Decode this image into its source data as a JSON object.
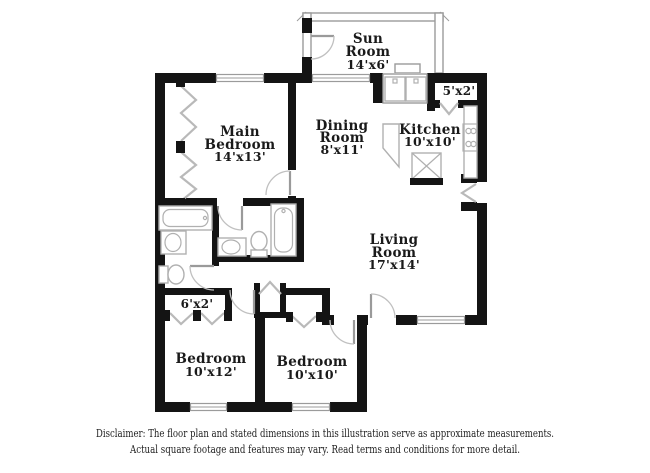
{
  "page": {
    "background": "#ffffff"
  },
  "colors": {
    "wall": "#141414",
    "fixture_outline": "#b0b0b0",
    "door_swing": "#c0c0c0",
    "label_text": "#1a1a1a"
  },
  "rooms": {
    "sun_room": {
      "line1": "Sun",
      "line2": "Room",
      "dims": "14'x6'"
    },
    "main_bedroom": {
      "line1": "Main",
      "line2": "Bedroom",
      "dims": "14'x13'"
    },
    "dining_room": {
      "line1": "Dining",
      "line2": "Room",
      "dims": "8'x11'"
    },
    "kitchen": {
      "line1": "Kitchen",
      "dims": "10'x10'"
    },
    "living_room": {
      "line1": "Living",
      "line2": "Room",
      "dims": "17'x14'"
    },
    "bedroom_left": {
      "line1": "Bedroom",
      "dims": "10'x12'"
    },
    "bedroom_right": {
      "line1": "Bedroom",
      "dims": "10'x10'"
    },
    "closet_upper": {
      "dims": "5'x2'"
    },
    "closet_hall": {
      "dims": "6'x2'"
    }
  },
  "disclaimer": {
    "line1": "Disclaimer: The floor plan and stated dimensions in this illustration serve as approximate measurements.",
    "line2": "Actual square footage and features may vary. Read terms and conditions for more detail."
  }
}
